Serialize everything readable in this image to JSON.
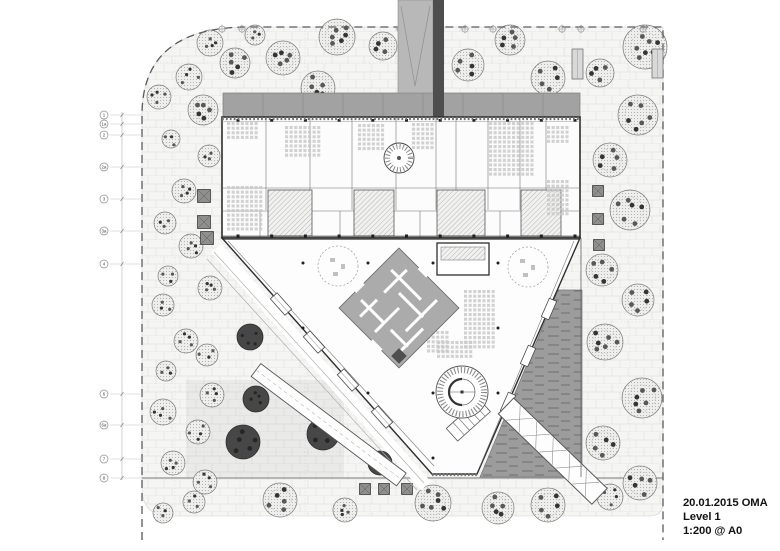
{
  "title_block": {
    "line1": "20.01.2015 OMA",
    "line2": "Level 1",
    "line3": "1:200 @ A0"
  },
  "plan": {
    "colors": {
      "paving": "#f5f5f3",
      "brick_line": "#e2e2e0",
      "boundary": "#5a5a5a",
      "canopy": "#a2a2a2",
      "canopy_seam": "#8a8a8a",
      "bridge": "#4e4e4e",
      "ramp_top": "#b8b8b8",
      "wall": "#2e2e2e",
      "partition": "#6a6a6a",
      "atrium": "#fdfdfd",
      "maze": "#ababab",
      "maze_line": "#ffffff",
      "water": "#9c9c9c",
      "water_dash": "#6e6e6e",
      "tree_stroke": "#7a7a7a",
      "tree_dark": "#474747",
      "column": "#1f1f1f",
      "furniture": "#c9c9c9",
      "bubble": "#8a8a8a",
      "text": "#141414"
    },
    "grid_bubbles_left": [
      {
        "label": "1",
        "y": 115
      },
      {
        "label": "1a",
        "y": 124
      },
      {
        "label": "2",
        "y": 135
      },
      {
        "label": "2a",
        "y": 167
      },
      {
        "label": "3",
        "y": 199
      },
      {
        "label": "3a",
        "y": 231
      },
      {
        "label": "4",
        "y": 264
      },
      {
        "label": "6",
        "y": 394
      },
      {
        "label": "6a",
        "y": 425
      },
      {
        "label": "7",
        "y": 459
      },
      {
        "label": "8",
        "y": 478
      }
    ],
    "grid_bubbles_top_x": [
      222,
      242,
      400,
      432,
      465,
      493,
      562,
      581,
      643
    ],
    "trees": [
      [
        210,
        43,
        13,
        "L"
      ],
      [
        255,
        35,
        10,
        "L"
      ],
      [
        235,
        63,
        15,
        "L"
      ],
      [
        283,
        58,
        17,
        "L"
      ],
      [
        337,
        37,
        18,
        "L"
      ],
      [
        383,
        46,
        14,
        "L"
      ],
      [
        318,
        88,
        17,
        "L"
      ],
      [
        159,
        97,
        12,
        "L"
      ],
      [
        189,
        77,
        13,
        "L"
      ],
      [
        203,
        110,
        15,
        "L"
      ],
      [
        468,
        65,
        16,
        "L"
      ],
      [
        510,
        40,
        15,
        "L"
      ],
      [
        548,
        78,
        17,
        "L"
      ],
      [
        600,
        73,
        14,
        "L"
      ],
      [
        645,
        47,
        22,
        "L"
      ],
      [
        638,
        115,
        20,
        "L"
      ],
      [
        610,
        160,
        17,
        "L"
      ],
      [
        171,
        139,
        9,
        "L"
      ],
      [
        209,
        156,
        11,
        "L"
      ],
      [
        184,
        191,
        12,
        "L"
      ],
      [
        165,
        223,
        11,
        "L"
      ],
      [
        191,
        246,
        12,
        "L"
      ],
      [
        168,
        276,
        10,
        "L"
      ],
      [
        163,
        305,
        11,
        "L"
      ],
      [
        210,
        288,
        12,
        "L"
      ],
      [
        186,
        341,
        12,
        "L"
      ],
      [
        207,
        355,
        11,
        "L"
      ],
      [
        166,
        371,
        10,
        "L"
      ],
      [
        163,
        412,
        13,
        "L"
      ],
      [
        212,
        395,
        12,
        "L"
      ],
      [
        198,
        432,
        12,
        "L"
      ],
      [
        173,
        463,
        12,
        "L"
      ],
      [
        205,
        482,
        12,
        "L"
      ],
      [
        163,
        513,
        10,
        "L"
      ],
      [
        250,
        337,
        13,
        "D"
      ],
      [
        256,
        399,
        13,
        "D"
      ],
      [
        243,
        442,
        17,
        "D"
      ],
      [
        323,
        434,
        16,
        "D"
      ],
      [
        380,
        463,
        12,
        "D"
      ],
      [
        194,
        502,
        11,
        "L"
      ],
      [
        280,
        500,
        17,
        "L"
      ],
      [
        345,
        510,
        12,
        "L"
      ],
      [
        433,
        503,
        18,
        "L"
      ],
      [
        498,
        508,
        16,
        "L"
      ],
      [
        548,
        505,
        17,
        "L"
      ],
      [
        610,
        497,
        13,
        "L"
      ],
      [
        640,
        483,
        17,
        "L"
      ],
      [
        630,
        210,
        20,
        "L"
      ],
      [
        602,
        270,
        16,
        "L"
      ],
      [
        638,
        300,
        16,
        "L"
      ],
      [
        605,
        342,
        18,
        "L"
      ],
      [
        642,
        398,
        20,
        "L"
      ],
      [
        603,
        443,
        17,
        "L"
      ]
    ],
    "planters": [
      [
        204,
        196,
        13
      ],
      [
        204,
        222,
        13
      ],
      [
        207,
        238,
        13
      ],
      [
        598,
        191,
        11
      ],
      [
        598,
        219,
        11
      ],
      [
        599,
        245,
        11
      ],
      [
        365,
        489,
        11
      ],
      [
        384,
        489,
        11
      ],
      [
        407,
        489,
        11
      ]
    ],
    "furniture_zones": [
      [
        227,
        122,
        7,
        4
      ],
      [
        227,
        186,
        8,
        10
      ],
      [
        285,
        126,
        8,
        7
      ],
      [
        358,
        124,
        6,
        6
      ],
      [
        412,
        123,
        5,
        6
      ],
      [
        489,
        122,
        10,
        12
      ],
      [
        547,
        126,
        5,
        4
      ],
      [
        547,
        180,
        5,
        8
      ],
      [
        464,
        290,
        7,
        13
      ],
      [
        427,
        331,
        5,
        5
      ],
      [
        437,
        341,
        8,
        4
      ],
      [
        442,
        264,
        7,
        2
      ]
    ],
    "kiosks": [
      [
        572,
        49,
        11,
        30
      ],
      [
        652,
        49,
        11,
        29
      ]
    ]
  }
}
